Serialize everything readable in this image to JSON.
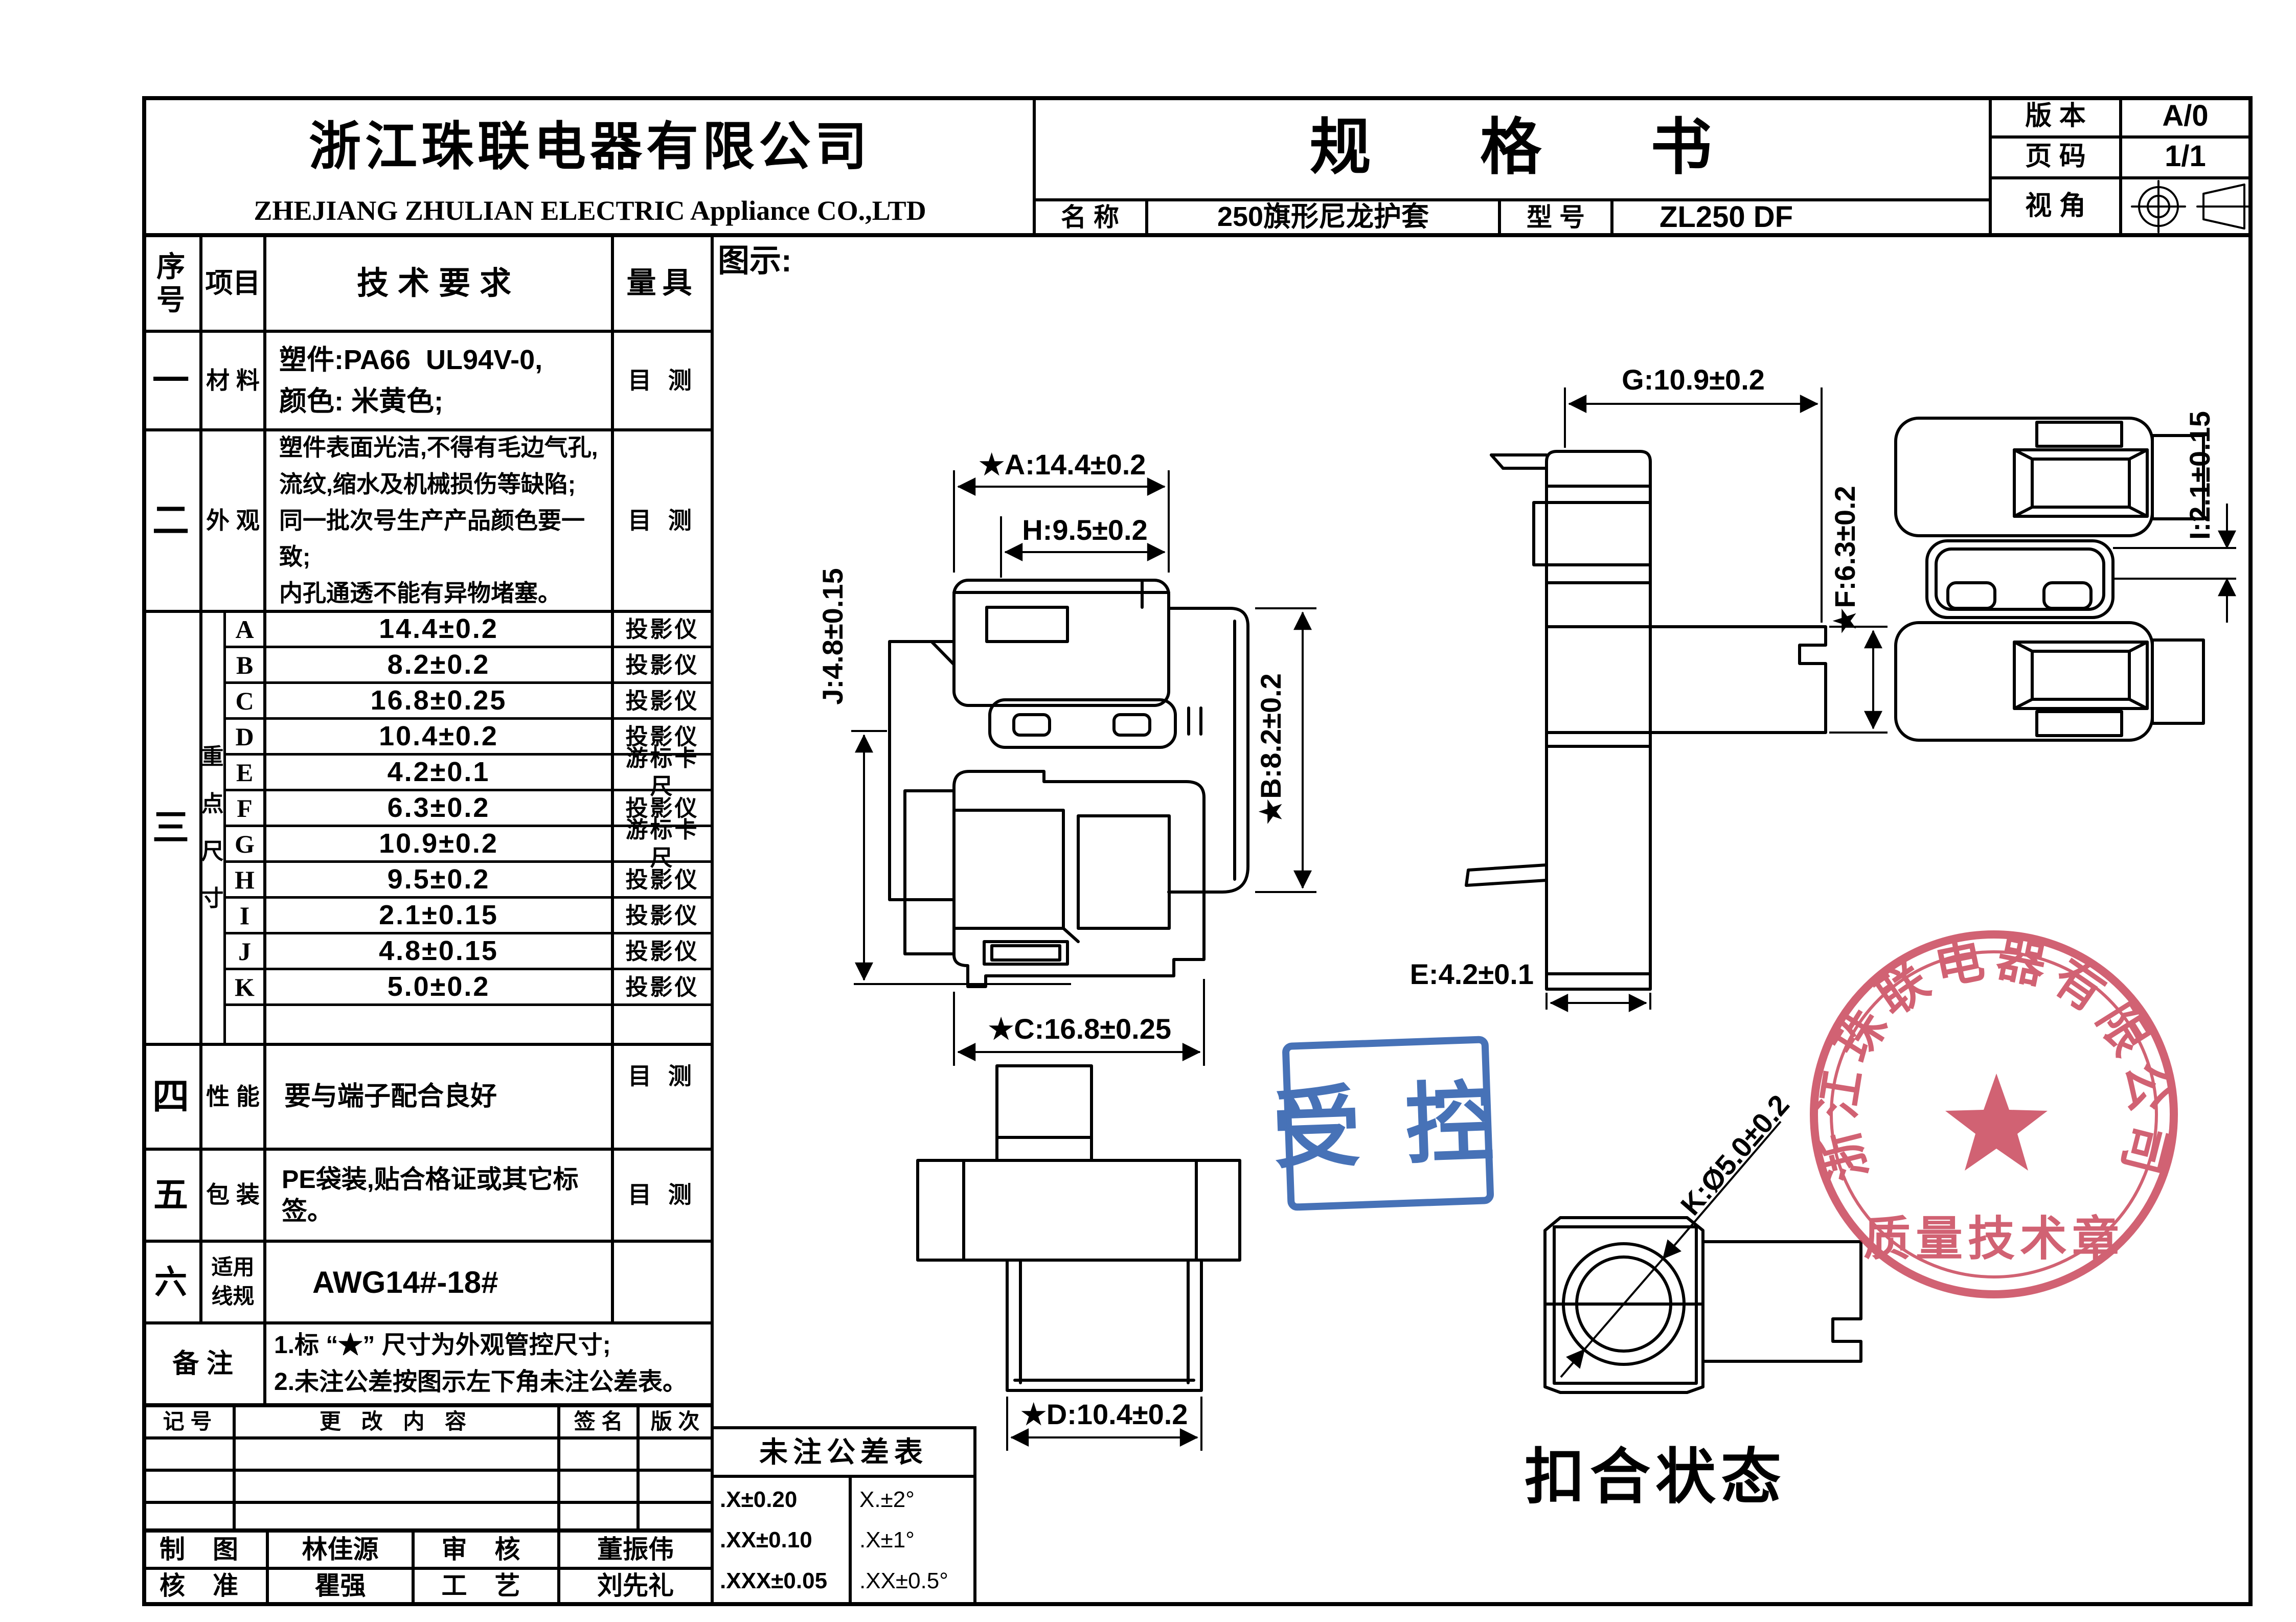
{
  "header": {
    "company_cn": "浙江珠联电器有限公司",
    "company_en": "ZHEJIANG ZHULIAN ELECTRIC Appliance CO.,LTD",
    "doc_title": "规 格 书",
    "version_label": "版 本",
    "version_value": "A/0",
    "page_label": "页 码",
    "page_value": "1/1",
    "view_label": "视 角",
    "name_label": "名 称",
    "name_value": "250旗形尼龙护套",
    "model_label": "型 号",
    "model_value": "ZL250 DF"
  },
  "spec_table": {
    "col_no": "序\n号",
    "col_item": "项目",
    "col_req": "技术要求",
    "col_gauge": "量具",
    "row1": {
      "no": "一",
      "item": "材 料",
      "req": "塑件:PA66  UL94V-0,\n颜色: 米黄色;",
      "gauge": "目 测"
    },
    "row2": {
      "no": "二",
      "item": "外 观",
      "req": "塑件表面光洁,不得有毛边气孔,\n流纹,缩水及机械损伤等缺陷;\n同一批次号生产产品颜色要一致;\n内孔通透不能有异物堵塞。",
      "gauge": "目 测"
    },
    "row3": {
      "no": "三",
      "group": "重\n点\n尺\n寸"
    },
    "dims": [
      {
        "letter": "A",
        "value": "14.4±0.2",
        "gauge": "投影仪"
      },
      {
        "letter": "B",
        "value": "8.2±0.2",
        "gauge": "投影仪"
      },
      {
        "letter": "C",
        "value": "16.8±0.25",
        "gauge": "投影仪"
      },
      {
        "letter": "D",
        "value": "10.4±0.2",
        "gauge": "投影仪"
      },
      {
        "letter": "E",
        "value": "4.2±0.1",
        "gauge": "游标卡尺"
      },
      {
        "letter": "F",
        "value": "6.3±0.2",
        "gauge": "投影仪"
      },
      {
        "letter": "G",
        "value": "10.9±0.2",
        "gauge": "游标卡尺"
      },
      {
        "letter": "H",
        "value": "9.5±0.2",
        "gauge": "投影仪"
      },
      {
        "letter": "I",
        "value": "2.1±0.15",
        "gauge": "投影仪"
      },
      {
        "letter": "J",
        "value": "4.8±0.15",
        "gauge": "投影仪"
      },
      {
        "letter": "K",
        "value": "5.0±0.2",
        "gauge": "投影仪"
      }
    ],
    "row4": {
      "no": "四",
      "item": "性 能",
      "req": "要与端子配合良好",
      "gauge": "目 测"
    },
    "row5": {
      "no": "五",
      "item": "包 装",
      "req": "PE袋装,贴合格证或其它标签。",
      "gauge": "目 测"
    },
    "row6": {
      "no": "六",
      "item": "适用\n线规",
      "req": "AWG14#-18#"
    },
    "remark": {
      "label": "备 注",
      "text": "1.标 “★” 尺寸为外观管控尺寸;\n2.未注公差按图示左下角未注公差表。"
    }
  },
  "revision_table": {
    "col_mark": "记 号",
    "col_content": "更 改 内 容",
    "col_sign": "签 名",
    "col_rev": "版 次"
  },
  "signatures": {
    "draw_label": "制 图",
    "draw_name": "林佳源",
    "check_label": "审 核",
    "check_name": "董振伟",
    "approve_label": "核 准",
    "approve_name": "瞿强",
    "process_label": "工 艺",
    "process_name": "刘先礼"
  },
  "tolerance_table": {
    "title": "未注公差表",
    "linear": ".X±0.20\n.XX±0.10\n.XXX±0.05",
    "angular": "X.±2°\n.X±1°\n.XX±0.5°"
  },
  "drawing": {
    "label": "图示:",
    "dim_a": "★A:14.4±0.2",
    "dim_h": "H:9.5±0.2",
    "dim_b": "★B:8.2±0.2",
    "dim_j": "J:4.8±0.15",
    "dim_c": "★C:16.8±0.25",
    "dim_g": "G:10.9±0.2",
    "dim_f": "★F:6.3±0.2",
    "dim_e": "E:4.2±0.1",
    "dim_i": "I:2.1±0.15",
    "dim_d": "★D:10.4±0.2",
    "dim_k": "K:Ø5.0±0.2",
    "caption": "扣合状态"
  },
  "stamps": {
    "controlled_text": "受 控",
    "quality_arc": "浙江珠联电器有限公司",
    "quality_bottom": "质量技术章",
    "blue": "#2e5fae",
    "red": "#c84055"
  }
}
